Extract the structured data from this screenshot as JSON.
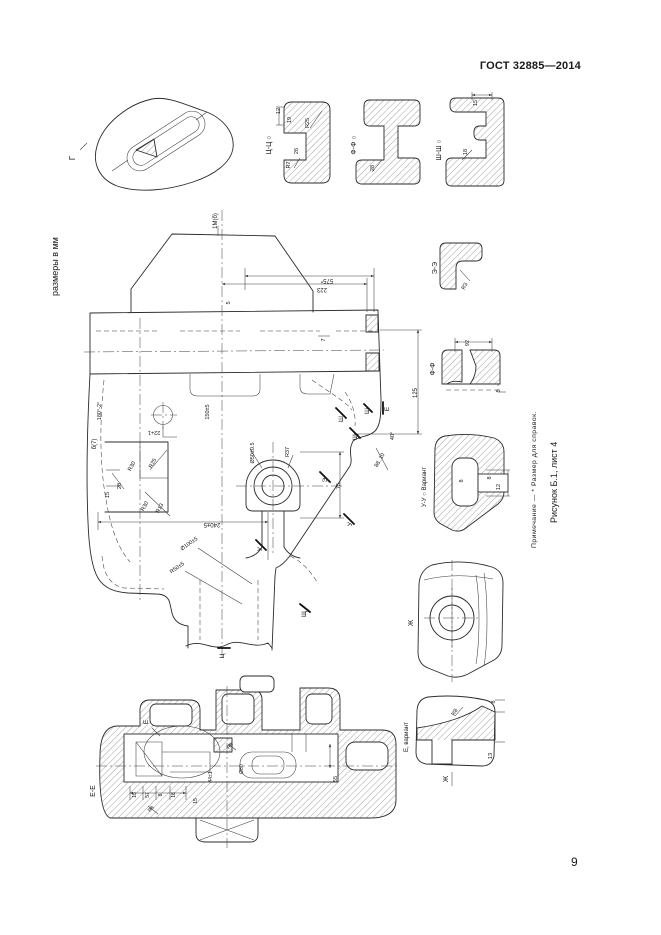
{
  "page": {
    "header": "ГОСТ 32885—2014",
    "page_number": "9",
    "units_note": "размеры в мм",
    "footnote": "Примечание — * Размер для справок.",
    "caption": "Рисунок Б.1, лист 4"
  },
  "figure": {
    "labels": [
      {
        "t": "Г",
        "x": 75,
        "y": 158,
        "r": -90,
        "s": 8
      },
      {
        "t": "Ц-Ц ○",
        "x": 271,
        "y": 145,
        "r": -90,
        "s": 7
      },
      {
        "t": "12",
        "x": 280,
        "y": 111,
        "r": -90,
        "s": 5.5
      },
      {
        "t": "19",
        "x": 291,
        "y": 120,
        "r": -90,
        "s": 5.5
      },
      {
        "t": "R25",
        "x": 309,
        "y": 123,
        "r": -90,
        "s": 5.5
      },
      {
        "t": "26",
        "x": 298,
        "y": 151,
        "r": -90,
        "s": 5.5
      },
      {
        "t": "R7",
        "x": 290,
        "y": 165,
        "r": -90,
        "s": 5.5
      },
      {
        "t": "Ф-Ф ○",
        "x": 356,
        "y": 145,
        "r": -90,
        "s": 7
      },
      {
        "t": "28",
        "x": 374,
        "y": 168,
        "r": -90,
        "s": 5.5
      },
      {
        "t": "Ш-Ш ○",
        "x": 441,
        "y": 150,
        "r": -90,
        "s": 7
      },
      {
        "t": "15",
        "x": 477,
        "y": 103,
        "r": -90,
        "s": 5.5
      },
      {
        "t": "18",
        "x": 467,
        "y": 152,
        "r": -90,
        "s": 5.5
      },
      {
        "t": "1М(б)",
        "x": 217,
        "y": 221,
        "r": -90,
        "s": 6
      },
      {
        "t": "575*",
        "x": 327,
        "y": 279,
        "r": 180,
        "s": 6
      },
      {
        "t": "223",
        "x": 322,
        "y": 288,
        "r": 180,
        "s": 6
      },
      {
        "t": "5",
        "x": 230,
        "y": 303,
        "r": -90,
        "s": 5.5
      },
      {
        "t": "7",
        "x": 325,
        "y": 340,
        "r": -90,
        "s": 5.5
      },
      {
        "t": "б(7)",
        "x": 96,
        "y": 444,
        "r": -90,
        "s": 6
      },
      {
        "t": "180°-2°",
        "x": 101,
        "y": 411,
        "r": -90,
        "s": 5.5
      },
      {
        "t": "150±5",
        "x": 209,
        "y": 412,
        "r": -90,
        "s": 5.5
      },
      {
        "t": "22+1",
        "x": 154,
        "y": 431,
        "r": 180,
        "s": 5.5
      },
      {
        "t": "R30",
        "x": 133,
        "y": 467,
        "r": -60,
        "s": 5.5
      },
      {
        "t": "R25",
        "x": 154,
        "y": 464,
        "r": -60,
        "s": 5.5
      },
      {
        "t": "28",
        "x": 121,
        "y": 486,
        "r": -90,
        "s": 5.5
      },
      {
        "t": "15",
        "x": 109,
        "y": 495,
        "r": -90,
        "s": 5.5
      },
      {
        "t": "R30",
        "x": 146,
        "y": 507,
        "r": -60,
        "s": 5.5
      },
      {
        "t": "R13",
        "x": 161,
        "y": 509,
        "r": -60,
        "s": 5.5
      },
      {
        "t": "Ø50±0.5",
        "x": 254,
        "y": 453,
        "r": -90,
        "s": 5.5
      },
      {
        "t": "R37",
        "x": 289,
        "y": 452,
        "r": -90,
        "s": 5.5
      },
      {
        "t": "75",
        "x": 340,
        "y": 486,
        "r": -90,
        "s": 5.5
      },
      {
        "t": "Э",
        "x": 327,
        "y": 480,
        "r": -90,
        "s": 6.5
      },
      {
        "t": "У",
        "x": 352,
        "y": 524,
        "r": -90,
        "s": 6.5
      },
      {
        "t": "У",
        "x": 262,
        "y": 549,
        "r": -90,
        "s": 6.5
      },
      {
        "t": "Ш",
        "x": 343,
        "y": 419,
        "r": -90,
        "s": 6.5
      },
      {
        "t": "Щ",
        "x": 357,
        "y": 437,
        "r": -90,
        "s": 6.5
      },
      {
        "t": "Ш",
        "x": 369,
        "y": 411,
        "r": -90,
        "s": 6.5
      },
      {
        "t": "Е",
        "x": 389,
        "y": 409,
        "r": -90,
        "s": 6.5
      },
      {
        "t": "88..10",
        "x": 381,
        "y": 461,
        "r": -60,
        "s": 5.5
      },
      {
        "t": "40°",
        "x": 394,
        "y": 436,
        "r": -90,
        "s": 5.5
      },
      {
        "t": "125",
        "x": 417,
        "y": 393,
        "r": -90,
        "s": 6
      },
      {
        "t": "240±5",
        "x": 212,
        "y": 523,
        "r": 180,
        "s": 6
      },
      {
        "t": "Ø100±5",
        "x": 190,
        "y": 545,
        "r": -35,
        "s": 5.5
      },
      {
        "t": "R50±5",
        "x": 178,
        "y": 569,
        "r": -35,
        "s": 5.5
      },
      {
        "t": "Ц",
        "x": 224,
        "y": 656,
        "r": -90,
        "s": 6.5
      },
      {
        "t": "Щ",
        "x": 306,
        "y": 614,
        "r": -90,
        "s": 6.5
      },
      {
        "t": "Э-Э",
        "x": 437,
        "y": 268,
        "r": -90,
        "s": 7
      },
      {
        "t": "R3",
        "x": 466,
        "y": 287,
        "r": -60,
        "s": 5.5
      },
      {
        "t": "Ф-Ф",
        "x": 435,
        "y": 369,
        "r": -90,
        "s": 7
      },
      {
        "t": "92",
        "x": 469,
        "y": 343,
        "r": -90,
        "s": 5.5
      },
      {
        "t": "5",
        "x": 500,
        "y": 391,
        "r": -90,
        "s": 5.5
      },
      {
        "t": "У-У ○ Вариант",
        "x": 426,
        "y": 487,
        "r": -90,
        "s": 6
      },
      {
        "t": "8",
        "x": 463,
        "y": 481,
        "r": -90,
        "s": 5.5
      },
      {
        "t": "8",
        "x": 491,
        "y": 478,
        "r": -90,
        "s": 5.5
      },
      {
        "t": "12",
        "x": 500,
        "y": 487,
        "r": -90,
        "s": 5.5
      },
      {
        "t": "Ж",
        "x": 413,
        "y": 623,
        "r": -90,
        "s": 7
      },
      {
        "t": "Ж",
        "x": 448,
        "y": 779,
        "r": -90,
        "s": 7
      },
      {
        "t": "Е, вариант",
        "x": 408,
        "y": 737,
        "r": -90,
        "s": 6
      },
      {
        "t": "R8",
        "x": 456,
        "y": 713,
        "r": -60,
        "s": 5.5
      },
      {
        "t": "8",
        "x": 495,
        "y": 702,
        "r": -90,
        "s": 5.5
      },
      {
        "t": "13",
        "x": 492,
        "y": 756,
        "r": -90,
        "s": 5.5
      },
      {
        "t": "Е-Е",
        "x": 95,
        "y": 791,
        "r": -90,
        "s": 7
      },
      {
        "t": "Е",
        "x": 148,
        "y": 722,
        "r": -90,
        "s": 6.5
      },
      {
        "t": "15",
        "x": 136,
        "y": 795,
        "r": -90,
        "s": 5
      },
      {
        "t": "57",
        "x": 149,
        "y": 795,
        "r": -90,
        "s": 5
      },
      {
        "t": "8",
        "x": 162,
        "y": 795,
        "r": -90,
        "s": 5
      },
      {
        "t": "18",
        "x": 175,
        "y": 795,
        "r": -90,
        "s": 5
      },
      {
        "t": "R8",
        "x": 152,
        "y": 810,
        "r": -45,
        "s": 5
      },
      {
        "t": "15",
        "x": 197,
        "y": 801,
        "r": -90,
        "s": 5
      },
      {
        "t": "44±1",
        "x": 212,
        "y": 777,
        "r": -90,
        "s": 5
      },
      {
        "t": "Ø80",
        "x": 243,
        "y": 769,
        "r": -90,
        "s": 5
      },
      {
        "t": "R8",
        "x": 231,
        "y": 747,
        "r": -45,
        "s": 5
      },
      {
        "t": "55",
        "x": 337,
        "y": 779,
        "r": -90,
        "s": 5.5
      }
    ]
  }
}
